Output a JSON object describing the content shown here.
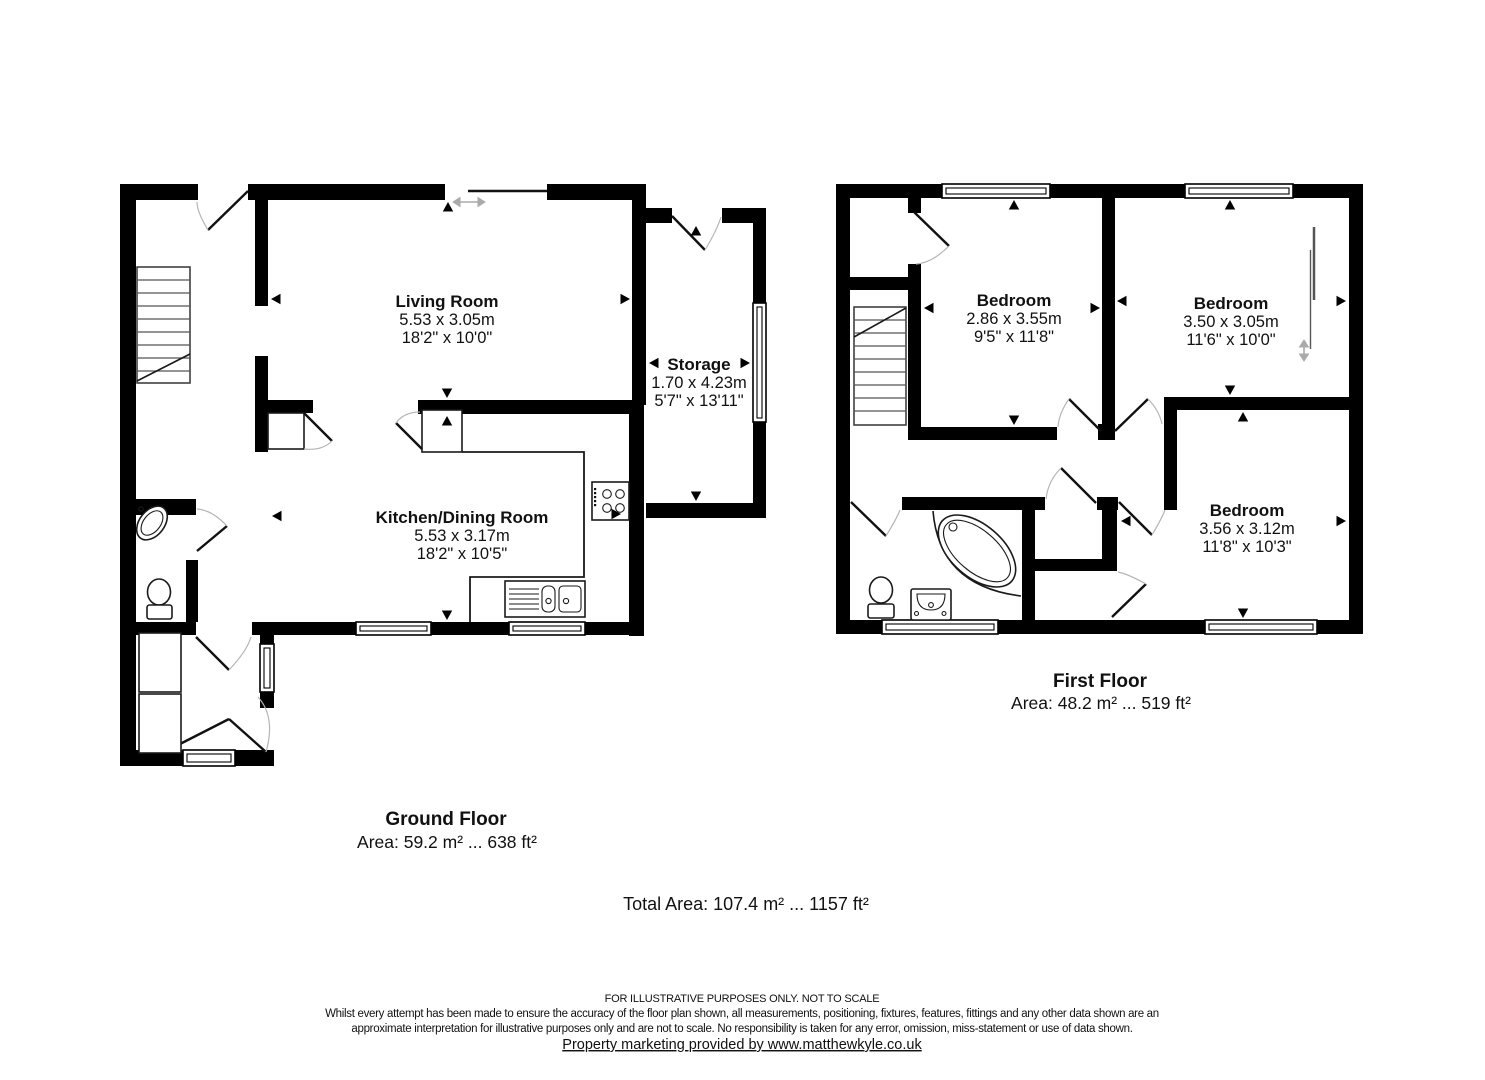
{
  "ground_floor": {
    "rooms": {
      "living_room": {
        "name": "Living Room",
        "metric": "5.53 x 3.05m",
        "imperial": "18'2\" x 10'0\""
      },
      "storage": {
        "name": "Storage",
        "metric": "1.70 x 4.23m",
        "imperial": "5'7\" x 13'11\""
      },
      "kitchen_dining": {
        "name": "Kitchen/Dining Room",
        "metric": "5.53 x 3.17m",
        "imperial": "18'2\" x 10'5\""
      }
    },
    "caption": {
      "title": "Ground Floor",
      "area": "Area: 59.2 m² ... 638 ft²"
    }
  },
  "first_floor": {
    "rooms": {
      "bedroom_1": {
        "name": "Bedroom",
        "metric": "2.86 x 3.55m",
        "imperial": "9'5\" x 11'8\""
      },
      "bedroom_2": {
        "name": "Bedroom",
        "metric": "3.50 x 3.05m",
        "imperial": "11'6\" x 10'0\""
      },
      "bedroom_3": {
        "name": "Bedroom",
        "metric": "3.56 x 3.12m",
        "imperial": "11'8\" x 10'3\""
      }
    },
    "caption": {
      "title": "First Floor",
      "area": "Area: 48.2 m² ... 519 ft²"
    }
  },
  "totals": {
    "total_area": "Total Area: 107.4 m² ... 1157 ft²"
  },
  "footer": {
    "line1": "FOR ILLUSTRATIVE PURPOSES ONLY. NOT TO SCALE",
    "line2": "Whilst every attempt has been made to ensure the accuracy of the floor plan shown, all measurements, positioning, fixtures, features, fittings and any other data shown are an",
    "line3": "approximate interpretation for illustrative purposes only and are not to scale. No responsibility is taken for any error, omission, miss-statement or use of data shown.",
    "link": "Property marketing provided by www.matthewkyle.co.uk"
  },
  "colors": {
    "wall": "#000000",
    "door_arc": "#b5b5b5",
    "background": "#ffffff"
  }
}
